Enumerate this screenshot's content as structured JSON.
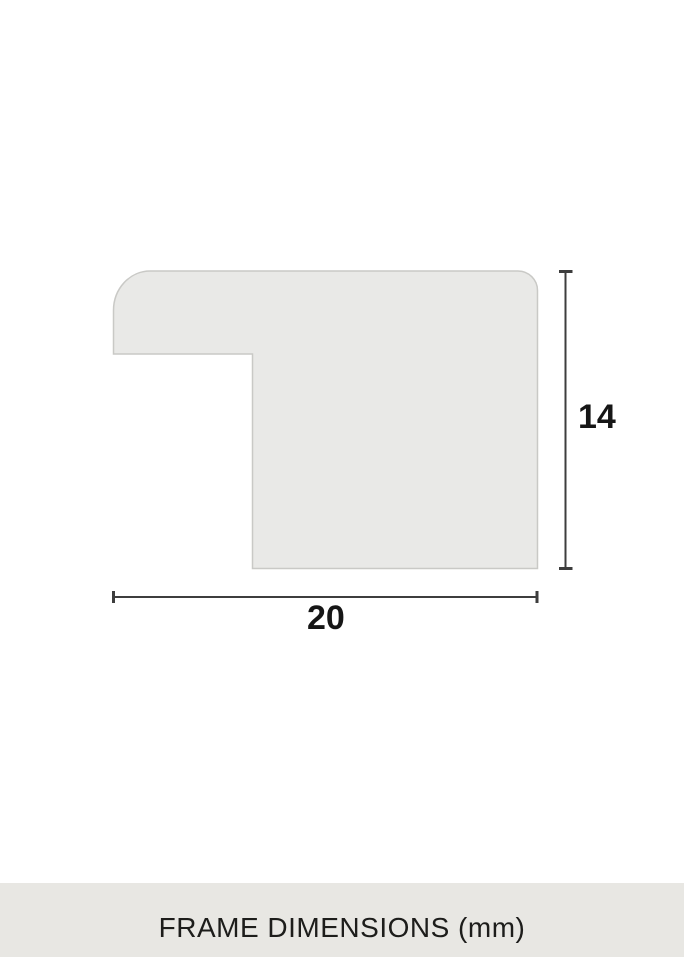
{
  "page": {
    "caption": "FRAME DIMENSIONS (mm)"
  },
  "diagram": {
    "type": "frame-profile-cross-section",
    "width_dimension": {
      "value": "20",
      "unit": "mm"
    },
    "height_dimension": {
      "value": "14",
      "unit": "mm"
    }
  },
  "colors": {
    "background": "#ffffff",
    "shape_fill": "#e9e9e7",
    "shape_stroke": "#c9c9c6",
    "dimension_line": "#3d3d3d",
    "text": "#161616",
    "caption_band_bg": "#e8e7e3",
    "caption_text": "#1d1d1b"
  }
}
